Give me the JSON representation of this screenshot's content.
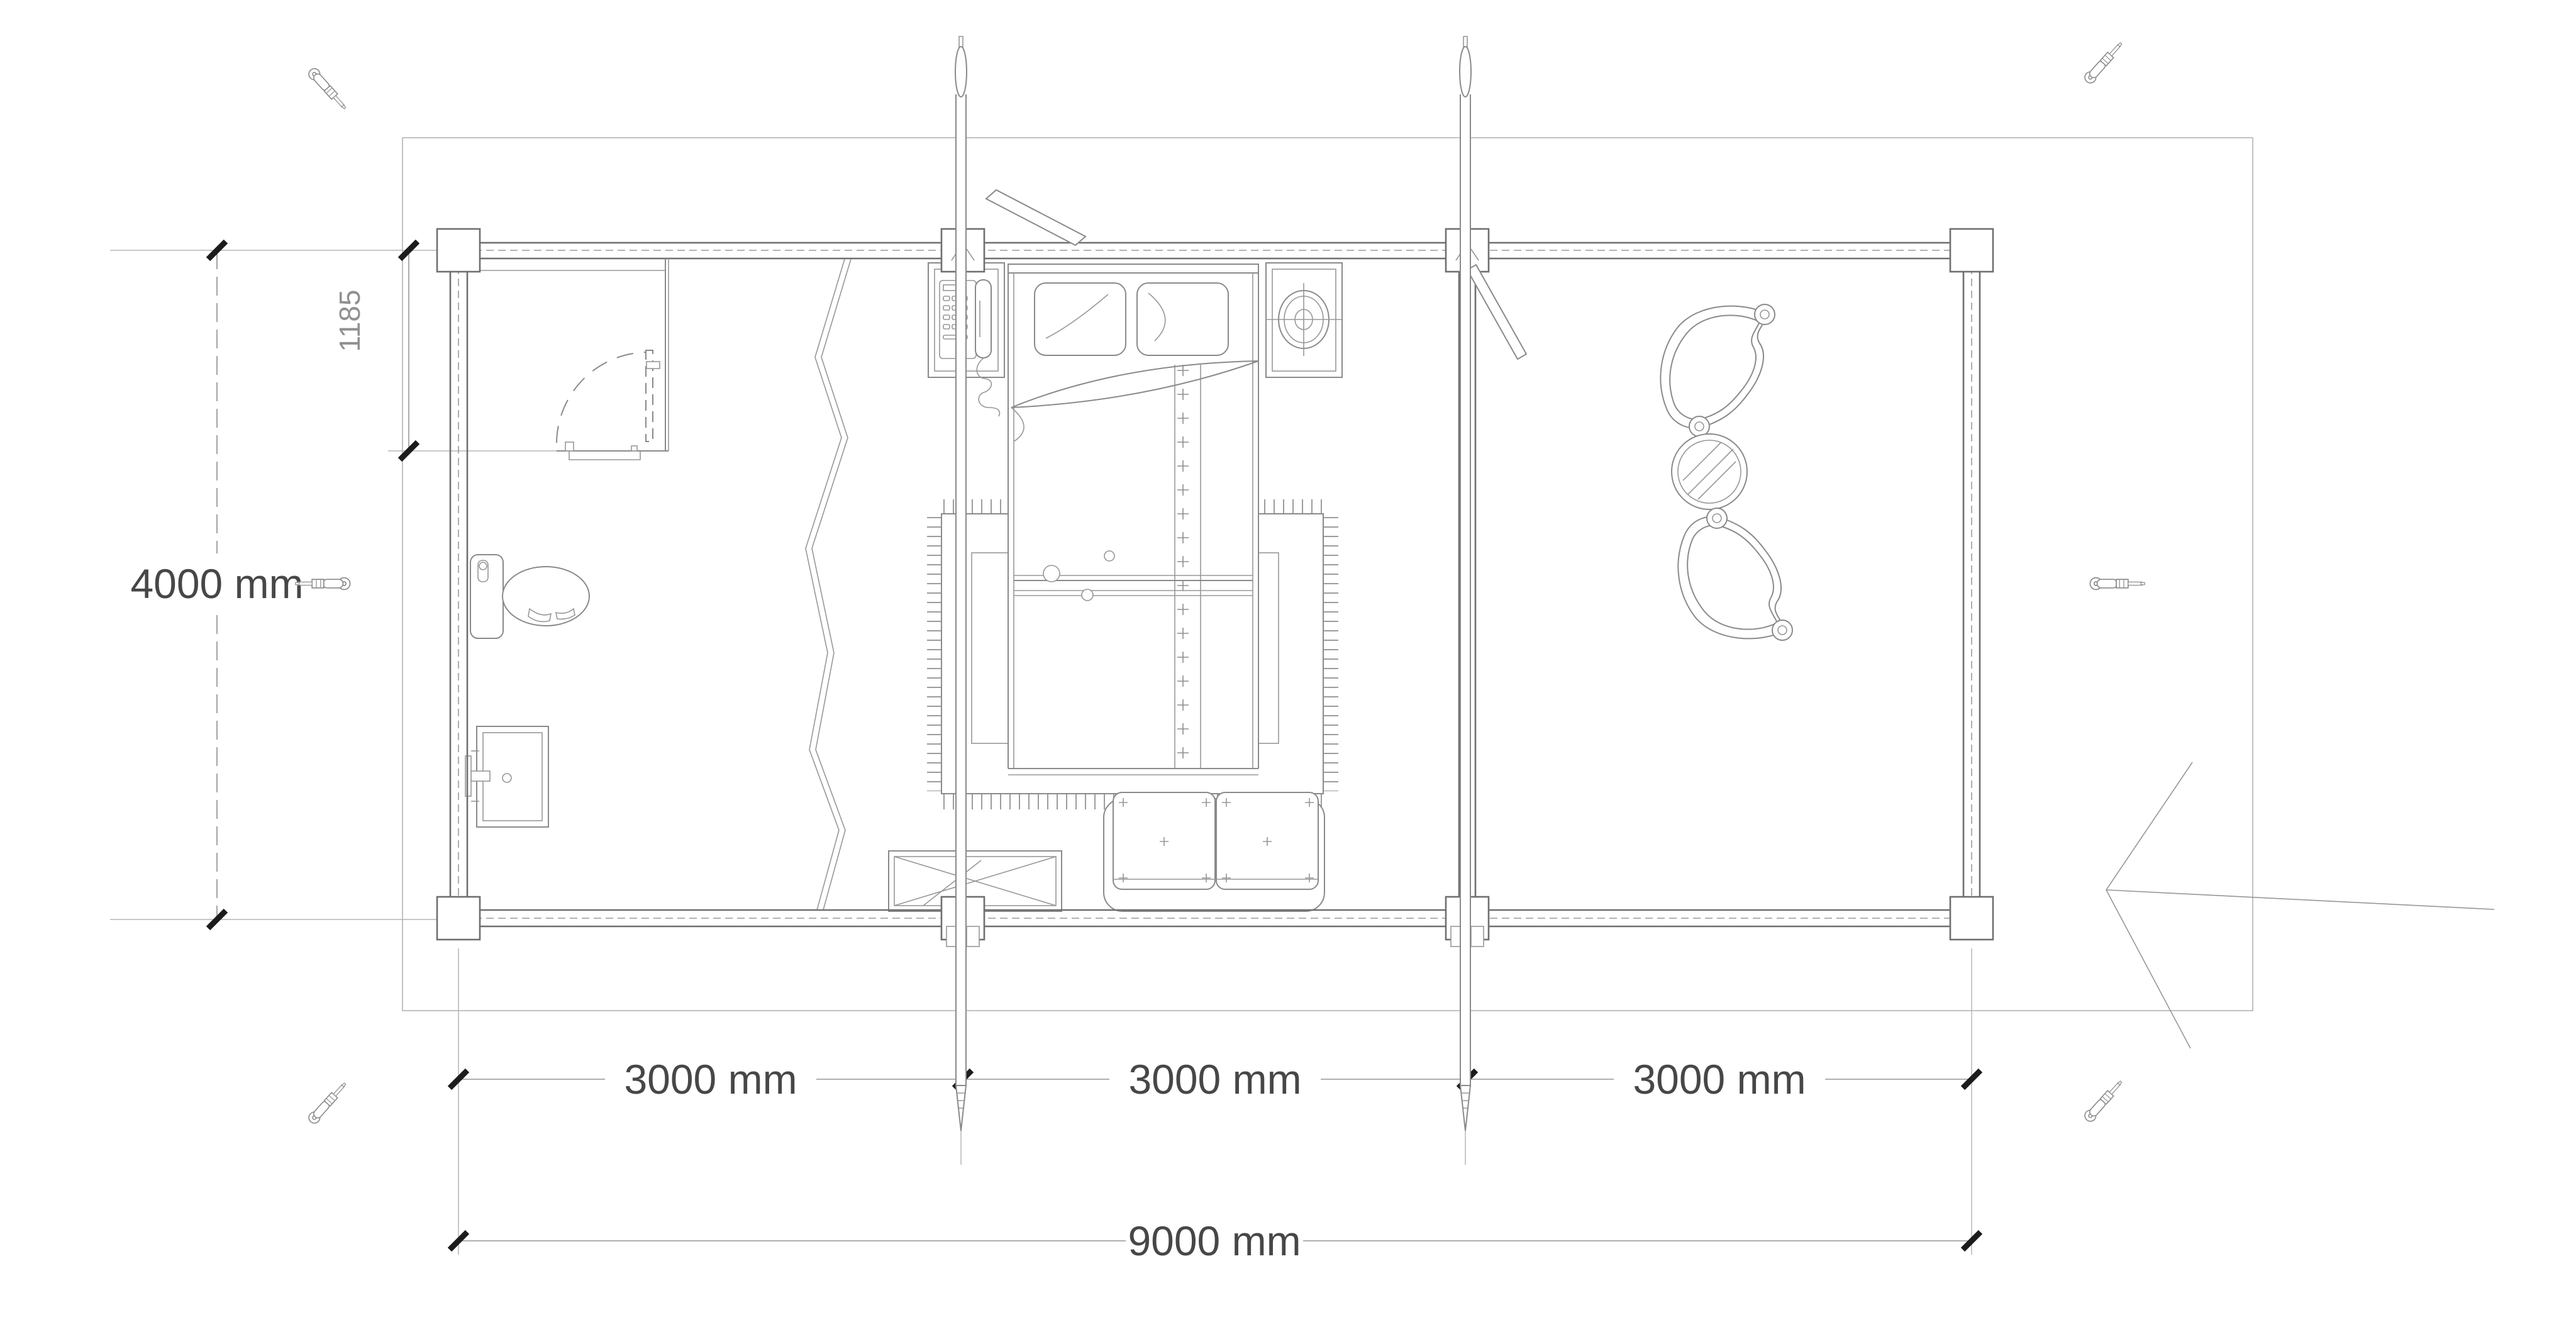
{
  "plan": {
    "type": "floor-plan",
    "building": "log cabin 9000 x 4000 mm with bedroom, bathroom and covered terrace",
    "dimensions": {
      "overall_width": {
        "label": "9000 mm",
        "value": 9000,
        "unit": "mm",
        "orientation": "horizontal"
      },
      "overall_height": {
        "label": "4000 mm",
        "value": 4000,
        "unit": "mm",
        "orientation": "vertical"
      },
      "bays": [
        {
          "label": "3000 mm",
          "value": 3000,
          "unit": "mm"
        },
        {
          "label": "3000 mm",
          "value": 3000,
          "unit": "mm"
        },
        {
          "label": "3000 mm",
          "value": 3000,
          "unit": "mm"
        }
      ],
      "door_wall_segment": {
        "label": "1185",
        "value": 1185,
        "orientation": "vertical"
      }
    },
    "symbols": [
      "double-bed",
      "pillow",
      "blanket-fold",
      "bed-runner",
      "area-rug",
      "nightstand",
      "telephone",
      "table-lamp",
      "toilet",
      "washbasin",
      "two-seat-sofa",
      "console-table-x-brace",
      "wicker-armchair",
      "round-coffee-table",
      "interior-door-swing",
      "partition-wall",
      "log-wall",
      "corner-post",
      "threaded-storm-rod",
      "screwdriver",
      "diagonal-brace",
      "entrance-arrow",
      "break-line"
    ],
    "colors": {
      "background": "#ffffff",
      "wall_line": "#6f6f6f",
      "furniture_line": "#8a8a8a",
      "site_line": "#bcbcbc",
      "dimension_text": "#474747",
      "dimension_text_secondary": "#909090",
      "tick_mark": "#1c1c1c"
    }
  }
}
